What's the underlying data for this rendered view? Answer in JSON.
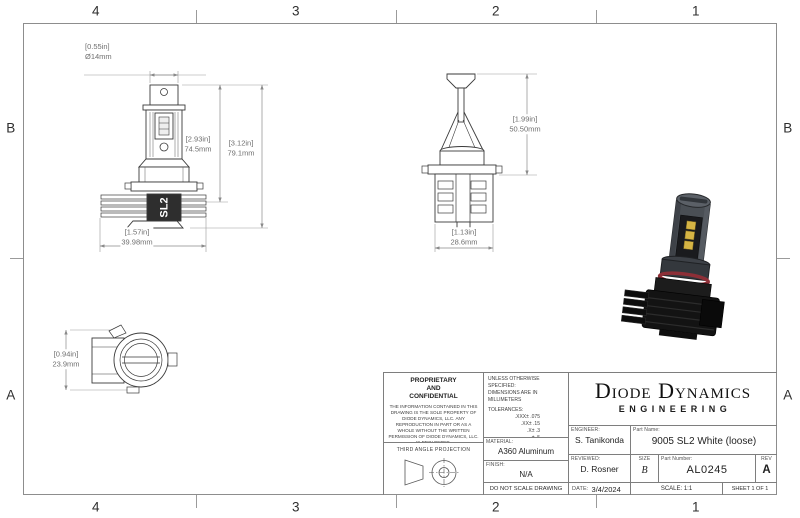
{
  "zones": {
    "columns": [
      "4",
      "3",
      "2",
      "1"
    ],
    "rows": [
      "B",
      "A"
    ]
  },
  "views": {
    "front": {
      "dim_diameter_in": "[0.55in]",
      "dim_diameter_mm": "Ø14mm",
      "dim_height1_in": "[2.93in]",
      "dim_height1_mm": "74.5mm",
      "dim_height2_in": "[3.12in]",
      "dim_height2_mm": "79.1mm",
      "dim_width_in": "[1.57in]",
      "dim_width_mm": "39.98mm",
      "logo": "SL2"
    },
    "side": {
      "dim_height_in": "[1.99in]",
      "dim_height_mm": "50.50mm",
      "dim_width_in": "[1.13in]",
      "dim_width_mm": "28.6mm"
    },
    "top": {
      "dim_height_in": "[0.94in]",
      "dim_height_mm": "23.9mm"
    }
  },
  "title_block": {
    "proprietary_title": "PROPRIETARY AND CONFIDENTIAL",
    "proprietary_body": "THE INFORMATION CONTAINED IN THIS DRAWING IS THE SOLE PROPERTY OF DIODE DYNAMICS, LLC.  ANY REPRODUCTION IN PART OR AS A WHOLE WITHOUT THE WRITTEN PERMISSION OF DIODE DYNAMICS, LLC. IS PROHIBITED.",
    "third_angle_label": "THIRD ANGLE PROJECTION",
    "spec_line1": "UNLESS OTHERWISE SPECIFIED:",
    "spec_line2": "DIMENSIONS ARE IN MILLIMETERS",
    "tolerances_label": "TOLERANCES:",
    "tolerances": [
      ".XXX± .075",
      ".XX± .15",
      ".X± .3",
      "± .5",
      "ANG± 1"
    ],
    "material_label": "MATERIAL:",
    "material_value": "A360 Aluminum",
    "finish_label": "FINISH:",
    "finish_value": "N/A",
    "do_not_scale": "DO NOT SCALE DRAWING",
    "engineer_label": "ENGINEER:",
    "engineer_value": "S. Tanikonda",
    "reviewed_label": "REVIEWED:",
    "reviewed_value": "D. Rosner",
    "date_label": "DATE:",
    "date_value": "3/4/2024",
    "company_name": "Diode Dynamics",
    "company_sub": "ENGINEERING",
    "part_name_label": "Part Name:",
    "part_name_value": "9005 SL2 White (loose)",
    "size_label": "SIZE",
    "size_value": "B",
    "part_number_label": "Part Number:",
    "part_number_value": "AL0245",
    "rev_label": "REV",
    "rev_value": "A",
    "scale_text": "SCALE: 1:1",
    "sheet_text": "SHEET 1 OF 1"
  },
  "palette": {
    "drawing_line": "#3a3a3a",
    "dimension_gray": "#6f6f6f",
    "frame_gray": "#8d8d8d",
    "oring_red": "#8d2f37",
    "led_yellow": "#d6b544",
    "heatsink_black": "#131313"
  }
}
